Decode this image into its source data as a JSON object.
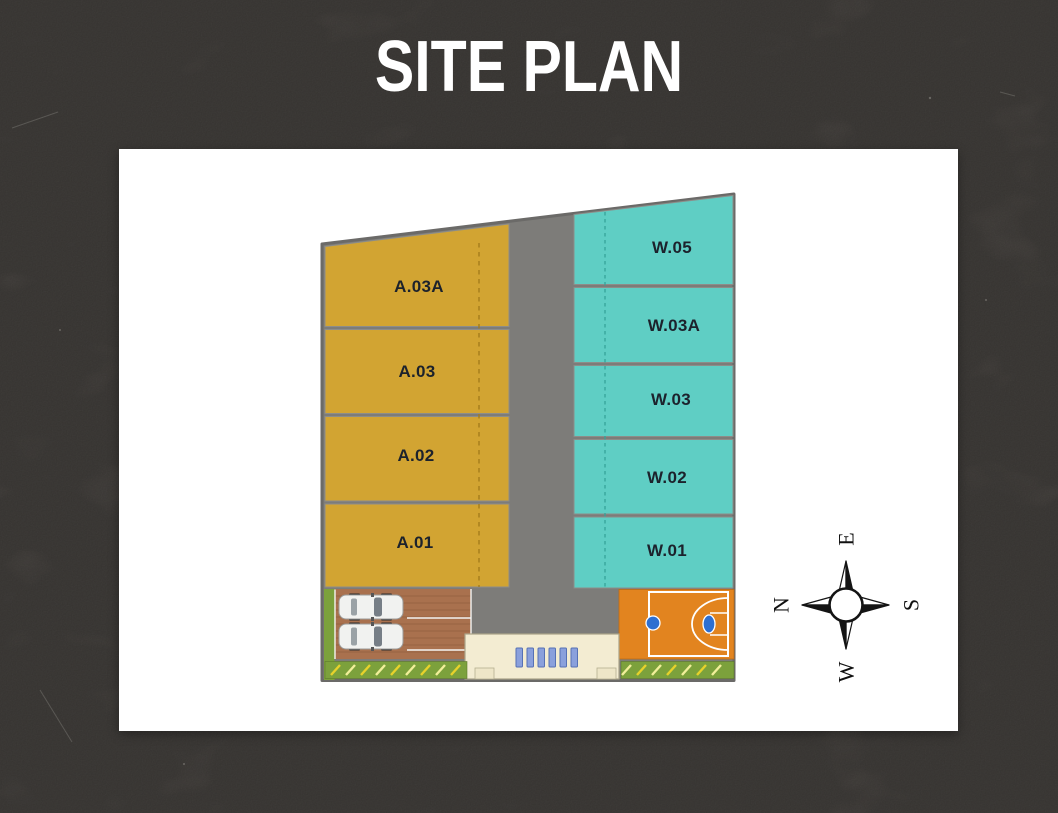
{
  "title": "SITE PLAN",
  "plan": {
    "a_blocks": [
      "A.03A",
      "A.03",
      "A.02",
      "A.01"
    ],
    "w_blocks": [
      "W.05",
      "W.03A",
      "W.03",
      "W.02",
      "W.01"
    ],
    "compass": {
      "top": "E",
      "left": "N",
      "right": "S",
      "bottom": "W"
    },
    "colors": {
      "background": "#57534f",
      "card": "#ffffff",
      "title_text": "#ffffff",
      "label_text": "#1c222c",
      "a_block": "#d2a432",
      "w_block": "#5fcec4",
      "road": "#7d7c79",
      "parking_paving": "#a9714e",
      "court": "#e2841f",
      "court_hoop": "#2e6fd0",
      "green": "#7ca13c",
      "hatch_yellow": "#e7d22b",
      "gate": "#f3ecd2",
      "gate_bars": "#8aa0dc"
    }
  }
}
